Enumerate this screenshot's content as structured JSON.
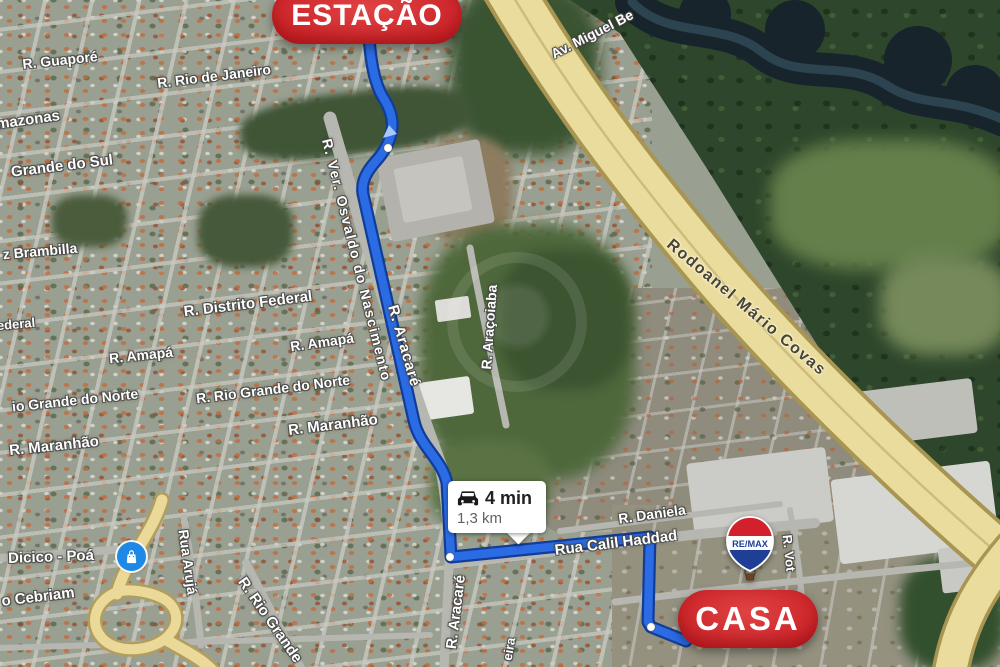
{
  "map": {
    "markers": {
      "origin": {
        "label": "ESTAÇÃO"
      },
      "destination": {
        "label": "CASA"
      },
      "route_info": {
        "duration": "4 min",
        "distance": "1,3 km",
        "icon": "car-icon"
      },
      "poi": {
        "icon": "shopping-bag-icon",
        "color": "#1e88e5"
      },
      "remax_logo": {
        "text": "RE/MAX",
        "top_color": "#d2212c",
        "mid_color": "#ffffff",
        "bottom_color": "#1f3f97"
      }
    },
    "route": {
      "path": "M368,24 C370,56 373,82 384,99 C392,112 394,123 391,134 C389,143 385,151 376,161 C367,171 361,181 363,194 L414,421 C420,447 442,459 447,483 L451,557 L650,537 L648,622 L651,627 L686,641",
      "color": "#2b6be4",
      "casing_color": "#123d96",
      "arrow_points": "389,125 397,134 383,138",
      "arrow_color": "#a8c7fa",
      "dots": [
        {
          "x": 388,
          "y": 148
        },
        {
          "x": 450,
          "y": 557
        },
        {
          "x": 651,
          "y": 627
        }
      ]
    },
    "labels": [
      {
        "text": "R. Guaporé",
        "x": 60,
        "y": 60,
        "rot": -6,
        "size": 14
      },
      {
        "text": "R. Rio de Janeiro",
        "x": 214,
        "y": 76,
        "rot": -7,
        "size": 14
      },
      {
        "text": "mazonas",
        "x": 28,
        "y": 120,
        "rot": -8,
        "size": 15
      },
      {
        "text": "Grande do Sul",
        "x": 62,
        "y": 166,
        "rot": -7,
        "size": 15
      },
      {
        "text": "z Brambilla",
        "x": 40,
        "y": 251,
        "rot": -5,
        "size": 14
      },
      {
        "text": "R. Distrito Federal",
        "x": 248,
        "y": 304,
        "rot": -7,
        "size": 15
      },
      {
        "text": "ederal",
        "x": 16,
        "y": 324,
        "rot": -5,
        "size": 13
      },
      {
        "text": "R. Amapá",
        "x": 141,
        "y": 355,
        "rot": -6,
        "size": 14
      },
      {
        "text": "R. Amapá",
        "x": 322,
        "y": 342,
        "rot": -8,
        "size": 14
      },
      {
        "text": "io Grande do Norte",
        "x": 75,
        "y": 400,
        "rot": -6,
        "size": 14
      },
      {
        "text": "R. Rio Grande do Norte",
        "x": 273,
        "y": 389,
        "rot": -7,
        "size": 14
      },
      {
        "text": "R. Maranhão",
        "x": 54,
        "y": 446,
        "rot": -6,
        "size": 15
      },
      {
        "text": "R. Maranhão",
        "x": 333,
        "y": 425,
        "rot": -7,
        "size": 15
      },
      {
        "text": "R. Ver. Osvaldo do Nascimento",
        "x": 357,
        "y": 260,
        "rot": 76,
        "size": 14,
        "ls": 1.5
      },
      {
        "text": "R. Aracaré",
        "x": 404,
        "y": 346,
        "rot": 74,
        "size": 15,
        "ls": 1
      },
      {
        "text": "R. Araçoiaba",
        "x": 489,
        "y": 327,
        "rot": -86,
        "size": 14
      },
      {
        "text": "Av. Miguel Be",
        "x": 592,
        "y": 34,
        "rot": -27,
        "size": 14
      },
      {
        "text": "Rodoanel Mário Covas",
        "x": 746,
        "y": 308,
        "rot": 40,
        "size": 16,
        "ls": 1.5,
        "variant": "highway"
      },
      {
        "text": "R. Daniela",
        "x": 652,
        "y": 514,
        "rot": -8,
        "size": 14
      },
      {
        "text": "Rua Calil Haddad",
        "x": 616,
        "y": 543,
        "rot": -7,
        "size": 15
      },
      {
        "text": "Dicico - Poá",
        "x": 51,
        "y": 557,
        "rot": -2,
        "size": 15
      },
      {
        "text": "o Cebriam",
        "x": 38,
        "y": 597,
        "rot": -7,
        "size": 15
      },
      {
        "text": "Rua Arujá",
        "x": 188,
        "y": 562,
        "rot": 82,
        "size": 14
      },
      {
        "text": "R. Rio Grande",
        "x": 270,
        "y": 620,
        "rot": 55,
        "size": 15
      },
      {
        "text": "R. Aracaré",
        "x": 456,
        "y": 612,
        "rot": -83,
        "size": 15
      },
      {
        "text": "eira",
        "x": 509,
        "y": 649,
        "rot": -80,
        "size": 13
      },
      {
        "text": "R. Vot",
        "x": 789,
        "y": 553,
        "rot": 84,
        "size": 13
      }
    ]
  }
}
